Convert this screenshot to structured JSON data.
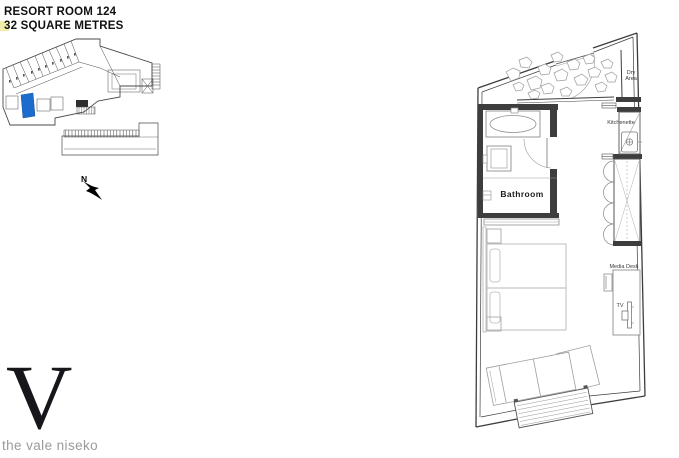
{
  "header": {
    "title_line1": "RESORT ROOM 124",
    "title_line2": "32 SQUARE METRES"
  },
  "north_indicator": {
    "label": "N"
  },
  "floorplan": {
    "labels": {
      "bathroom": "Bathroom",
      "dry_area_line1": "Dry",
      "dry_area_line2": "Area",
      "kitchenette": "Kitchenette",
      "media_desk": "Media Desk",
      "tv": "TV"
    }
  },
  "overview_map": {
    "highlight_color": "#1b6ccc"
  },
  "logo": {
    "mark": "V",
    "tagline": "the vale niseko"
  },
  "colors": {
    "wall": "#3d3d3d",
    "furniture": "#8f8f8f",
    "light_line": "#b7b7b7",
    "artifact_yellow": "#f2edaa",
    "tagline_gray": "#9a9a9a"
  }
}
